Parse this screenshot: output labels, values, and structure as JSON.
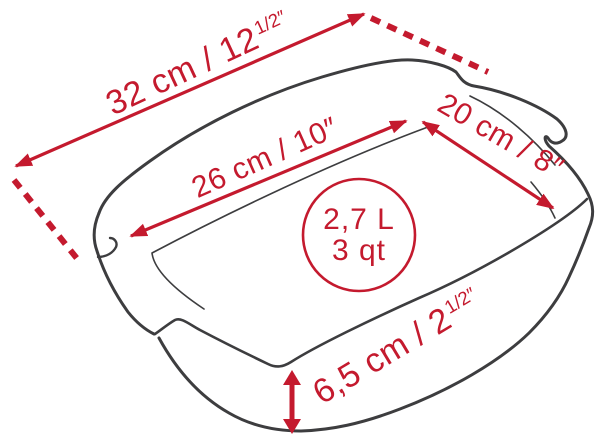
{
  "figure": {
    "subject": "rectangular baking dish line drawing with dimension callouts",
    "accent_color": "#c41a2e",
    "line_color": "#3d3d3f"
  },
  "dimensions": {
    "outer_length": {
      "text": "32 cm / 12",
      "sup": "1/2″"
    },
    "inner_length": {
      "text": "26 cm / 10″",
      "sup": ""
    },
    "width": {
      "text": "20 cm / 8″",
      "sup": ""
    },
    "height": {
      "text": "6,5 cm / 2",
      "sup": "1/2″"
    },
    "capacity": {
      "liters": "2,7 L",
      "quarts": "3 qt"
    }
  }
}
